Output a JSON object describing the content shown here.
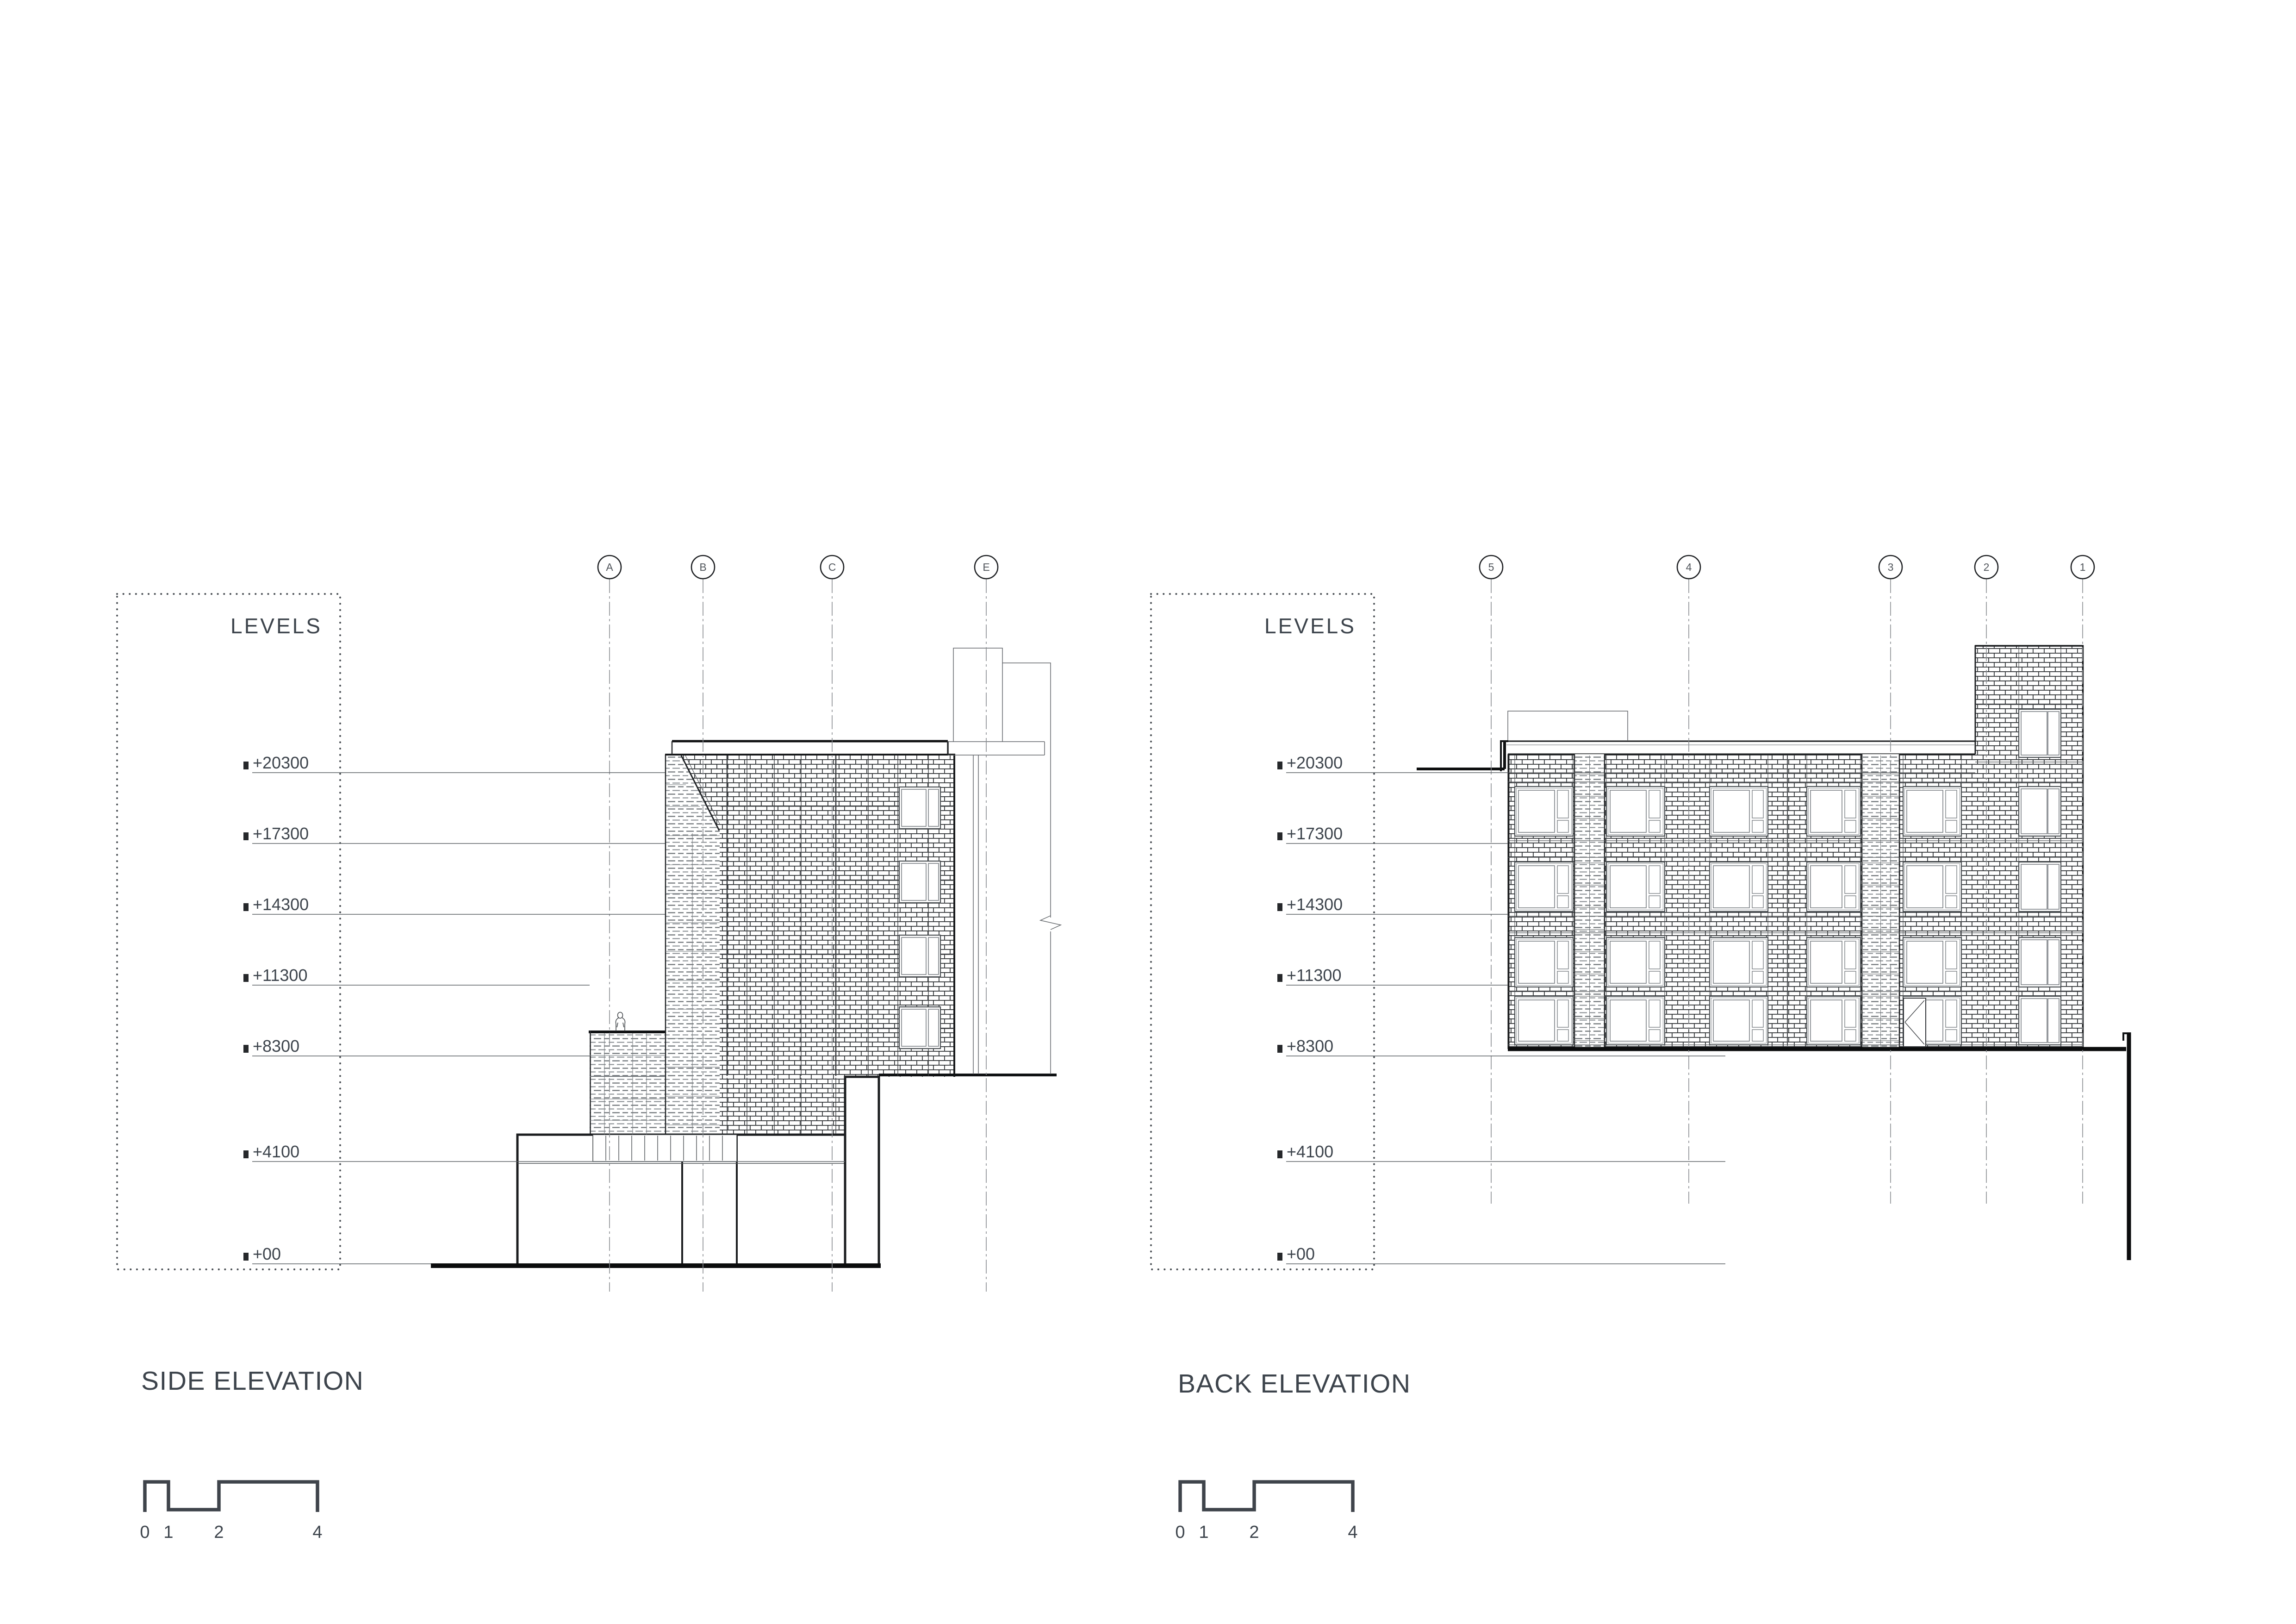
{
  "sheet": {
    "type": "architectural elevation drawing",
    "background": "#ffffff"
  },
  "levels_panel": {
    "title": "LEVELS",
    "labels": [
      "+20300",
      "+17300",
      "+14300",
      "+11300",
      "+8300",
      "+4100",
      "+00"
    ]
  },
  "side_elevation": {
    "title": "SIDE ELEVATION",
    "grid_bubbles": [
      "A",
      "B",
      "C",
      "E"
    ]
  },
  "back_elevation": {
    "title": "BACK ELEVATION",
    "grid_bubbles": [
      "5",
      "4",
      "3",
      "2",
      "1"
    ]
  },
  "scale_bar": {
    "labels": [
      "0",
      "1",
      "2",
      "4"
    ]
  },
  "icons": {
    "human_figure": "standing-person-outline",
    "door_swing": "double-door-swing",
    "break_line": "zigzag-break-symbol"
  },
  "colors": {
    "ink": "#17191b",
    "medium_line": "#35383b",
    "light_line": "#6b7074",
    "text": "#3d444c"
  }
}
